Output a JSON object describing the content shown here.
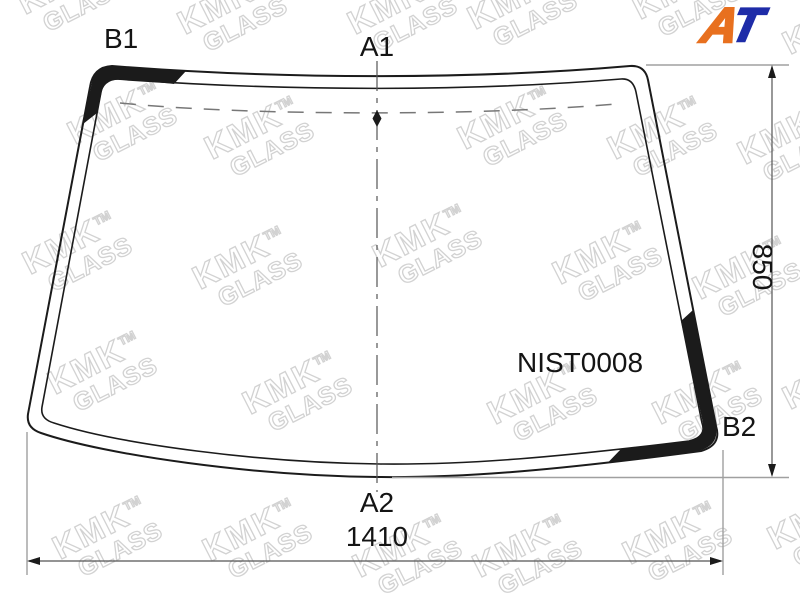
{
  "part_number": "NIST0008",
  "labels": {
    "top_left": "B1",
    "top_center": "A1",
    "bottom_right": "B2",
    "bottom_center": "A2"
  },
  "dimensions": {
    "height": "850",
    "width": "1410"
  },
  "watermark": {
    "name": "KMK",
    "tm": "TM",
    "sub": "GLASS"
  },
  "logo": {
    "a": "A",
    "t": "T"
  },
  "colors": {
    "logo_a": "#e8701f",
    "logo_t": "#1e2ca8",
    "band": "#1b1b1b",
    "watermark_outline": "#d2d2d2"
  }
}
